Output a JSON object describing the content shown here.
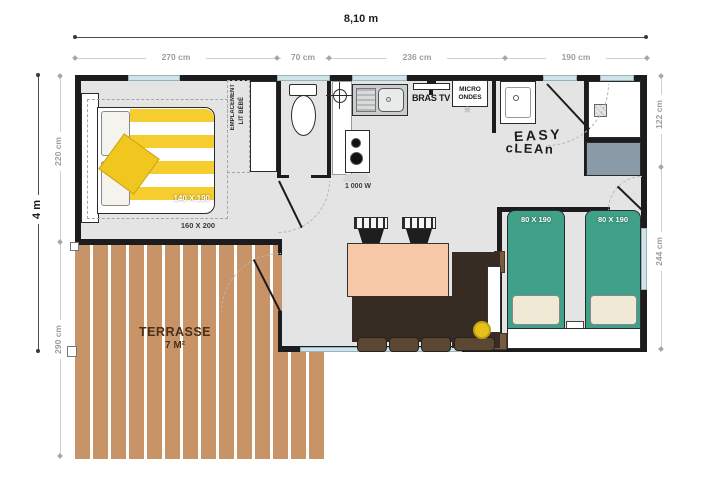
{
  "dims": {
    "total_width": "8,10 m",
    "total_height": "4 m",
    "top": [
      "270 cm",
      "70 cm",
      "236 cm",
      "190 cm"
    ],
    "left": [
      "220 cm",
      "290 cm"
    ],
    "right": [
      "122 cm",
      "244 cm"
    ]
  },
  "bedroom": {
    "bed_size": "140 X 190",
    "zone_size": "160 X 200",
    "baby_space_line1": "EMPLACEMENT",
    "baby_space_line2": "LIT BÉBÉ"
  },
  "kitchen": {
    "hob_power": "1 000 W",
    "tv_bracket": "BRAS TV",
    "microwave_line1": "MICRO",
    "microwave_line2": "ONDES",
    "freezer_symbol": "*"
  },
  "bathroom": {
    "easy": "EASY",
    "clean": "cLEAn"
  },
  "twin_bedroom": {
    "bed_left_size": "80 X 190",
    "bed_right_size": "80 X 190"
  },
  "terrace": {
    "name": "TERRASSE",
    "area": "7 M²"
  },
  "colors": {
    "wall": "#1c1c1e",
    "floor": "#e3e4e3",
    "window": "#cfe3e9",
    "wood": "#c89366",
    "bed_yellow": "#f5cb2a",
    "bed_teal": "#3fa189",
    "table_salmon": "#f8c9a9",
    "sofa_brown": "#362c23",
    "unit_slate": "#8b9aa7"
  }
}
